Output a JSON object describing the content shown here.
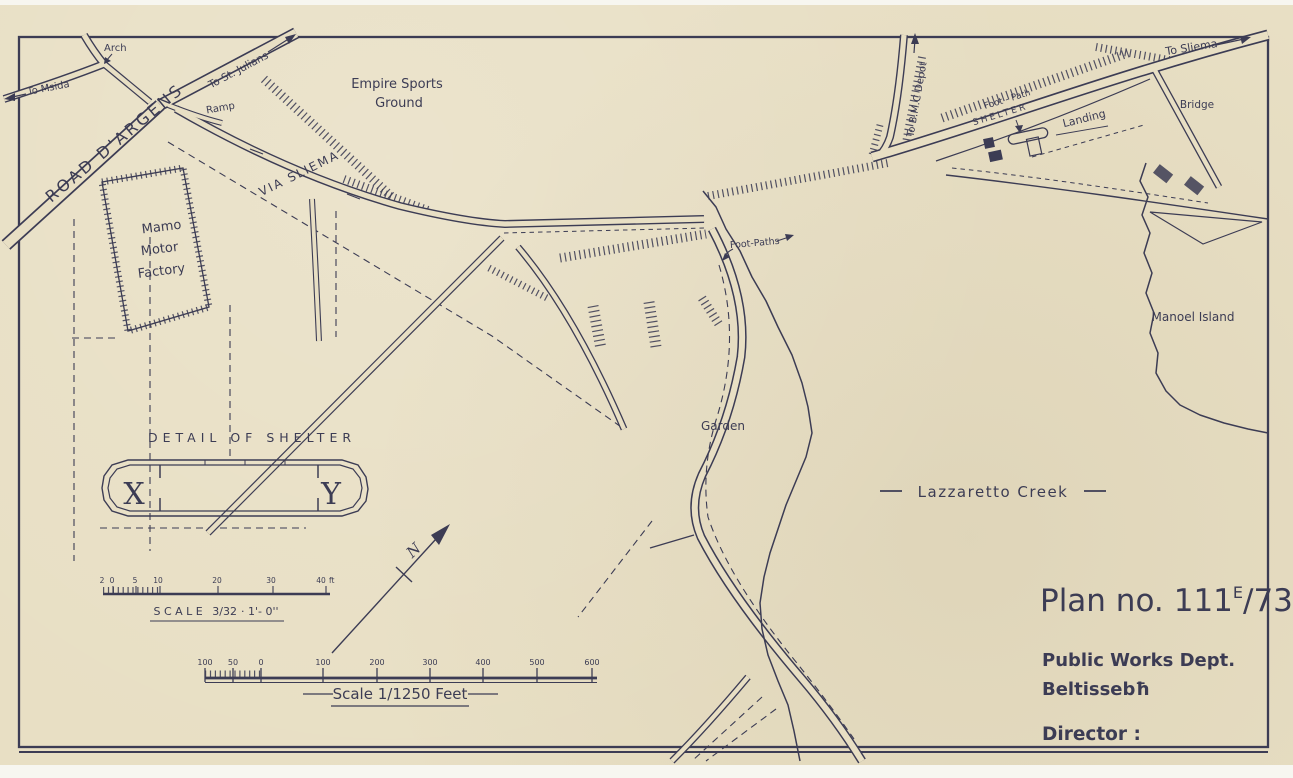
{
  "title_block": {
    "plan_no_prefix": "Plan no.",
    "plan_no_main": "111",
    "plan_no_sup": "E",
    "plan_no_rest": "/73",
    "department": "Public Works Dept.",
    "location": "Beltissebħ",
    "director": "Director :"
  },
  "labels": {
    "road_dargens": "ROAD D'ARGENS",
    "via_sliema": "VIA SLIEMA",
    "to_msida": "To Msida",
    "arch": "Arch",
    "to_st_julians": "To St. Julians",
    "ramp": "Ramp",
    "empire_1": "Empire Sports",
    "empire_2": "Ground",
    "mamo_1": "Mamo",
    "mamo_2": "Motor",
    "mamo_3": "Factory",
    "foot_paths": "Foot-Paths",
    "garden": "Garden",
    "lazzaretto": "Lazzaretto Creek",
    "manoel_island": "Manoel Island",
    "to_bmc": "To B.M.C Depot",
    "foot_path": "Foot - Path",
    "shelter": "SHELTER",
    "landing": "Landing",
    "to_sliema": "To Sliema",
    "bridge": "Bridge"
  },
  "detail": {
    "title": "DETAIL OF SHELTER",
    "x": "X",
    "y": "Y"
  },
  "north": "N",
  "scale_small": {
    "ticks": [
      "2",
      "0",
      "5",
      "10",
      "20",
      "30",
      "40"
    ],
    "unit": "ft",
    "caption_label": "SCALE",
    "caption_ratio": "3/32",
    "caption_rest": "· 1'- 0''"
  },
  "scale_large": {
    "ticks": [
      "100",
      "50",
      "0",
      "100",
      "200",
      "300",
      "400",
      "500",
      "600"
    ],
    "caption": "Scale 1/1250 Feet"
  },
  "colors": {
    "ink": "#3c3c54",
    "paper": "#e8dfc4"
  }
}
